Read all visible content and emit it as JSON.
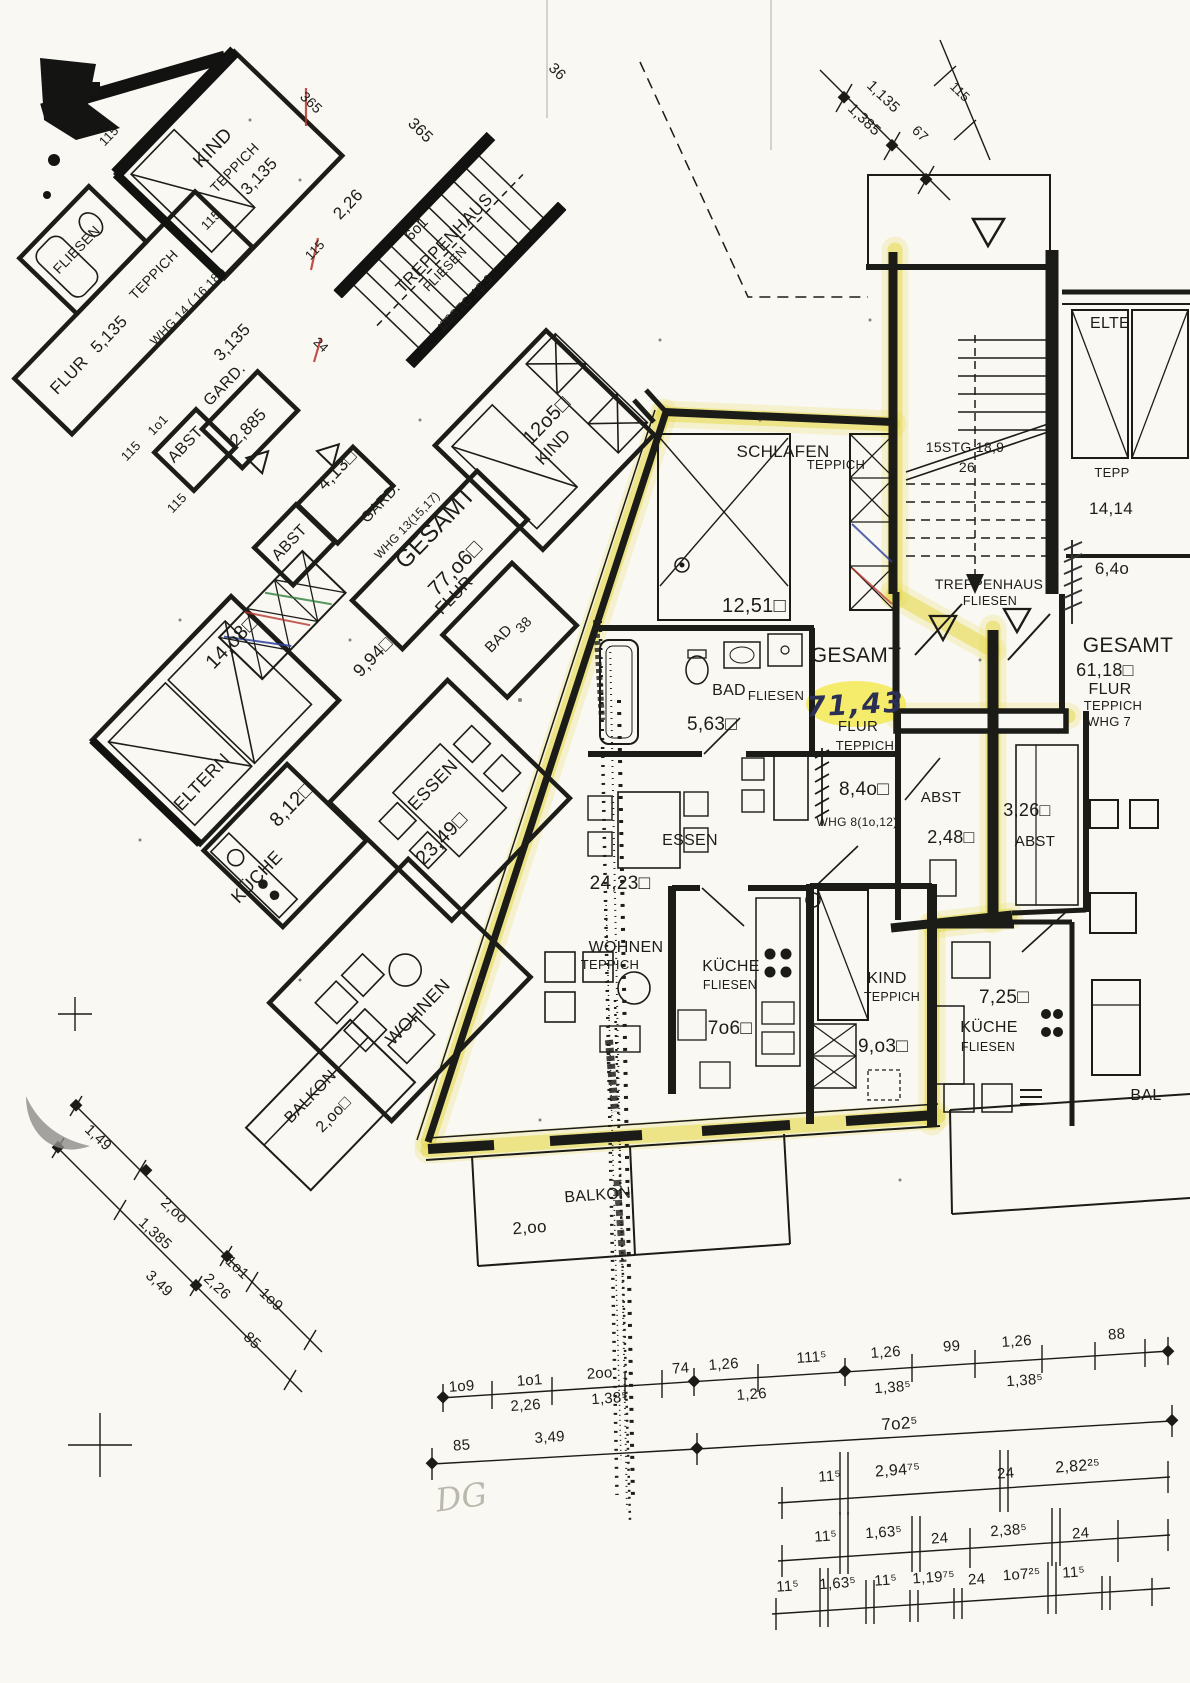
{
  "colors": {
    "paper": "#f9f8f3",
    "ink": "#1b1b17",
    "highlighter": "#e6dc4f",
    "pen_annotation": "#2b2f55",
    "pencil": "#bcb8ae",
    "red_mark": "#b5342c",
    "blue_mark": "#2b3f9e",
    "green_mark": "#2e7d3a"
  },
  "wing_labels": [
    {
      "t": "KIND"
    },
    {
      "t": "TEPPICH"
    },
    {
      "t": "3,135"
    },
    {
      "t": "115"
    },
    {
      "t": "115"
    },
    {
      "t": "2,26"
    },
    {
      "t": "115"
    },
    {
      "t": "365"
    },
    {
      "t": "36"
    },
    {
      "t": "365"
    },
    {
      "t": "FLIESEN"
    },
    {
      "t": "TEPPICH"
    },
    {
      "t": "WHG 14 ( 16,18 )"
    },
    {
      "t": "FLUR"
    },
    {
      "t": "5,135"
    },
    {
      "t": "115"
    },
    {
      "t": "1o1"
    },
    {
      "t": "3,135"
    },
    {
      "t": "ABST"
    },
    {
      "t": "GARD."
    },
    {
      "t": "2,885"
    },
    {
      "t": "115"
    },
    {
      "t": "24"
    },
    {
      "t": "ABST"
    },
    {
      "t": "4,13□"
    },
    {
      "t": "GARD."
    },
    {
      "t": "WHG 13(15,17)"
    },
    {
      "t": "GESAMT"
    },
    {
      "t": "77,o6□"
    },
    {
      "t": "FLUR"
    },
    {
      "t": "12o5□"
    },
    {
      "t": "KIND"
    },
    {
      "t": "38"
    },
    {
      "t": "BAD"
    },
    {
      "t": "14,o8□"
    },
    {
      "t": "ELTERN"
    },
    {
      "t": "9,94□"
    },
    {
      "t": "KÜCHE"
    },
    {
      "t": "8,12□"
    },
    {
      "t": "ESSEN"
    },
    {
      "t": "23,49□"
    },
    {
      "t": "WOHNEN"
    },
    {
      "t": "BALKON"
    },
    {
      "t": "2,oo□"
    },
    {
      "t": "TREPPENHAUS"
    },
    {
      "t": "FLIESEN"
    },
    {
      "t": "6o1"
    },
    {
      "t": "15 STG 18,9"
    },
    {
      "t": "26"
    },
    {
      "t": "1,135"
    },
    {
      "t": "1,385"
    },
    {
      "t": "115"
    },
    {
      "t": "67"
    }
  ],
  "main_labels": [
    {
      "t": "SCHLAFEN"
    },
    {
      "t": "TEPPICH"
    },
    {
      "t": "12,51□"
    },
    {
      "t": "15STG 18,9"
    },
    {
      "t": "26"
    },
    {
      "t": "TREPPENHAUS"
    },
    {
      "t": "FLIESEN"
    },
    {
      "t": "ELTE"
    },
    {
      "t": "TEPP"
    },
    {
      "t": "14,14"
    },
    {
      "t": "6,4o"
    },
    {
      "t": "GESAMT"
    },
    {
      "t": "GESAMT"
    },
    {
      "t": "61,18□"
    },
    {
      "t": "FLUR"
    },
    {
      "t": "TEPPICH"
    },
    {
      "t": "WHG 7"
    },
    {
      "t": "BAD"
    },
    {
      "t": "FLIESEN"
    },
    {
      "t": "5,63□"
    },
    {
      "t": "FLUR"
    },
    {
      "t": "TEPPICH"
    },
    {
      "t": "8,4o□"
    },
    {
      "t": "WHG 8(1o,12)"
    },
    {
      "t": "ABST"
    },
    {
      "t": "2,48□"
    },
    {
      "t": "3,26□"
    },
    {
      "t": "ABST"
    },
    {
      "t": "ESSEN"
    },
    {
      "t": "24,23□"
    },
    {
      "t": "WOHNEN"
    },
    {
      "t": "TEPPICH"
    },
    {
      "t": "KÜCHE"
    },
    {
      "t": "FLIESEN"
    },
    {
      "t": "7o6□"
    },
    {
      "t": "KIND"
    },
    {
      "t": "TEPPICH"
    },
    {
      "t": "9,o3□"
    },
    {
      "t": "7,25□"
    },
    {
      "t": "KÜCHE"
    },
    {
      "t": "FLIESEN"
    },
    {
      "t": "BALKON"
    },
    {
      "t": "2,oo"
    },
    {
      "t": "BAL"
    }
  ],
  "annotations": [
    {
      "t": "71,43",
      "meaning": "handwritten total area of highlighted apartment"
    },
    {
      "t": "DG",
      "meaning": "pencil note"
    }
  ],
  "dim_labels": [
    {
      "t": "1,49"
    },
    {
      "t": "2,oo"
    },
    {
      "t": "1,385"
    },
    {
      "t": "1o1"
    },
    {
      "t": "1o9"
    },
    {
      "t": "2,26"
    },
    {
      "t": "3,49"
    },
    {
      "t": "85"
    },
    {
      "t": "1o9"
    },
    {
      "t": "1o1"
    },
    {
      "t": "2oo"
    },
    {
      "t": "74"
    },
    {
      "t": "1,26"
    },
    {
      "t": "111⁵"
    },
    {
      "t": "1,26"
    },
    {
      "t": "99"
    },
    {
      "t": "1,26"
    },
    {
      "t": "88"
    },
    {
      "t": "2,26"
    },
    {
      "t": "1,38⁵"
    },
    {
      "t": "1,26"
    },
    {
      "t": "1,38⁵"
    },
    {
      "t": "1,38⁵"
    },
    {
      "t": "85"
    },
    {
      "t": "3,49"
    },
    {
      "t": "7o2⁵"
    },
    {
      "t": "11⁵"
    },
    {
      "t": "2,94⁷⁵"
    },
    {
      "t": "24"
    },
    {
      "t": "2,82²⁵"
    },
    {
      "t": "11⁵"
    },
    {
      "t": "1,63⁵"
    },
    {
      "t": "24"
    },
    {
      "t": "2,38⁵"
    },
    {
      "t": "24"
    },
    {
      "t": "11⁵"
    },
    {
      "t": "1,63⁵"
    },
    {
      "t": "11⁵"
    },
    {
      "t": "1,19⁷⁵"
    },
    {
      "t": "24"
    },
    {
      "t": "1o7²⁵"
    },
    {
      "t": "11⁵"
    }
  ]
}
